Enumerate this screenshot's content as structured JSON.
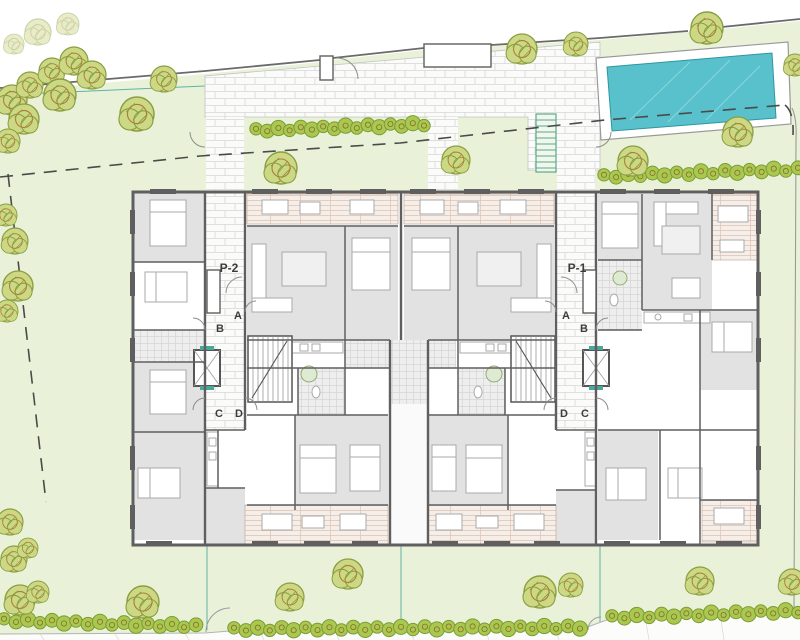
{
  "labels": {
    "entrance_left": "P-2",
    "entrance_right": "P-1",
    "unit_a": "A",
    "unit_b": "B",
    "unit_c": "C",
    "unit_d": "D"
  },
  "colors": {
    "lawn": "#e9f2d8",
    "accent_teal": "#49a89a",
    "pool_water": "#58c1cb",
    "pool_edge": "#2e96a0",
    "pool_highlight": "#8ad8df",
    "tree_fill": "#cbd985",
    "tree_stroke": "#8d9c40",
    "tree_inner": "#b07a36",
    "hedge_fill": "#a9c850",
    "hedge_stroke": "#7d9a33",
    "hedge_inner": "#8a6a2a",
    "wall": "#5f5f5f",
    "room_gray": "#e2e2e2",
    "boundary": "#6a6a6a",
    "dashed_boundary": "#4a4a4a",
    "label_color": "#3c3c3c"
  },
  "landscape": {
    "trees": [
      {
        "x": 12,
        "y": 100,
        "r": 15
      },
      {
        "x": 30,
        "y": 85,
        "r": 13
      },
      {
        "x": 52,
        "y": 71,
        "r": 13
      },
      {
        "x": 74,
        "y": 61,
        "r": 14
      },
      {
        "x": 92,
        "y": 75,
        "r": 14
      },
      {
        "x": 60,
        "y": 95,
        "r": 16
      },
      {
        "x": 24,
        "y": 119,
        "r": 15
      },
      {
        "x": 8,
        "y": 141,
        "r": 12
      },
      {
        "x": 137,
        "y": 114,
        "r": 17
      },
      {
        "x": 164,
        "y": 79,
        "r": 13
      },
      {
        "x": 281,
        "y": 168,
        "r": 16
      },
      {
        "x": 456,
        "y": 160,
        "r": 14
      },
      {
        "x": 633,
        "y": 161,
        "r": 15
      },
      {
        "x": 522,
        "y": 49,
        "r": 15
      },
      {
        "x": 576,
        "y": 44,
        "r": 12
      },
      {
        "x": 707,
        "y": 28,
        "r": 16
      },
      {
        "x": 795,
        "y": 65,
        "r": 11
      },
      {
        "x": 738,
        "y": 132,
        "r": 15
      },
      {
        "x": 6,
        "y": 215,
        "r": 11
      },
      {
        "x": 15,
        "y": 241,
        "r": 13
      },
      {
        "x": 18,
        "y": 286,
        "r": 15
      },
      {
        "x": 7,
        "y": 311,
        "r": 11
      },
      {
        "x": 10,
        "y": 522,
        "r": 13
      },
      {
        "x": 14,
        "y": 559,
        "r": 13
      },
      {
        "x": 28,
        "y": 548,
        "r": 10
      },
      {
        "x": 20,
        "y": 600,
        "r": 15
      },
      {
        "x": 38,
        "y": 592,
        "r": 11
      },
      {
        "x": 143,
        "y": 602,
        "r": 16
      },
      {
        "x": 290,
        "y": 597,
        "r": 14
      },
      {
        "x": 348,
        "y": 574,
        "r": 15
      },
      {
        "x": 540,
        "y": 592,
        "r": 16
      },
      {
        "x": 571,
        "y": 585,
        "r": 12
      },
      {
        "x": 700,
        "y": 581,
        "r": 14
      },
      {
        "x": 792,
        "y": 582,
        "r": 13
      },
      {
        "x": 38,
        "y": 32,
        "r": 13,
        "faint": true
      },
      {
        "x": 68,
        "y": 24,
        "r": 11,
        "faint": true
      },
      {
        "x": 14,
        "y": 44,
        "r": 10,
        "faint": true
      }
    ],
    "hedges": [
      {
        "x1": 256,
        "y1": 130,
        "x2": 424,
        "y2": 124,
        "n": 16
      },
      {
        "x1": 604,
        "y1": 176,
        "x2": 798,
        "y2": 169,
        "n": 17
      },
      {
        "x1": 4,
        "y1": 620,
        "x2": 196,
        "y2": 626,
        "n": 17
      },
      {
        "x1": 234,
        "y1": 629,
        "x2": 580,
        "y2": 627,
        "n": 30
      },
      {
        "x1": 612,
        "y1": 617,
        "x2": 798,
        "y2": 611,
        "n": 16
      }
    ]
  }
}
